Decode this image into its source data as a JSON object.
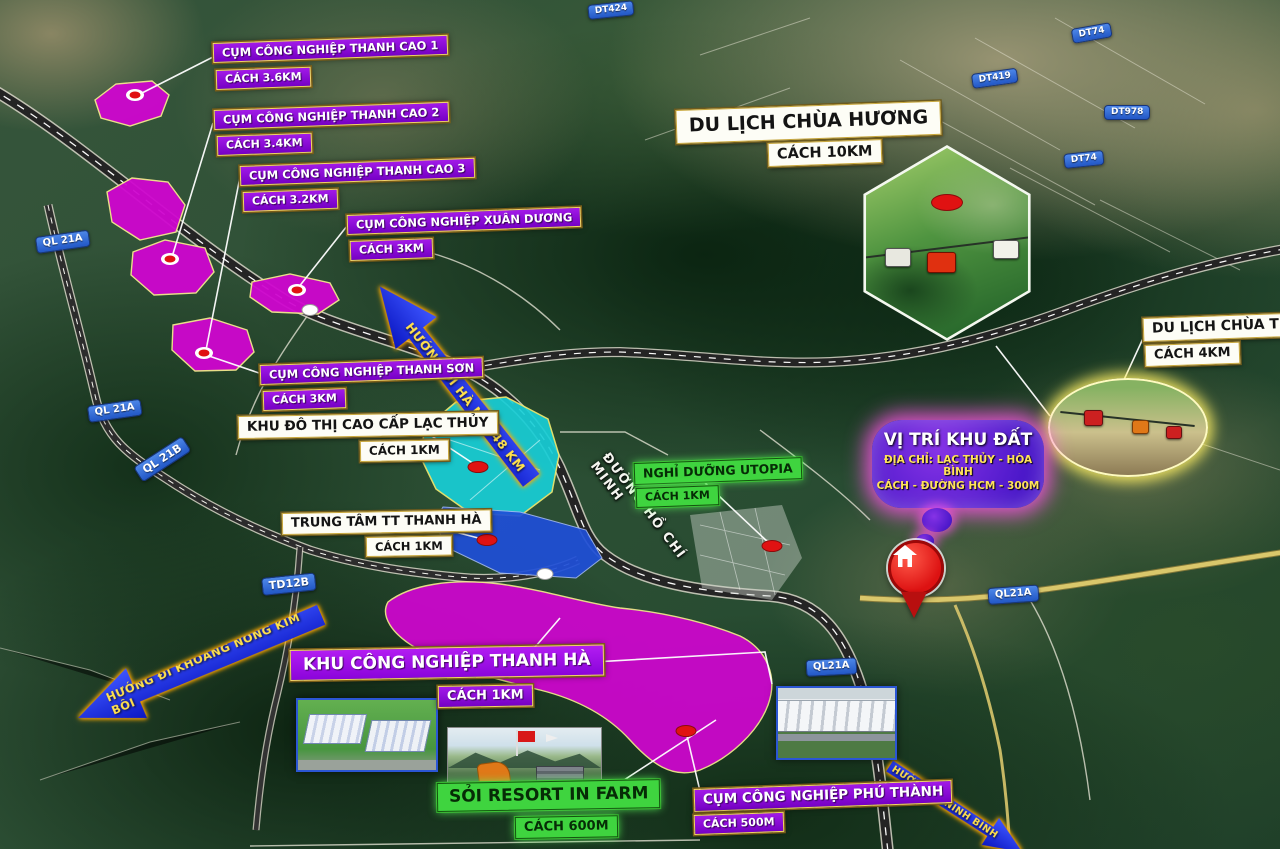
{
  "pois": {
    "thanh_cao_1": {
      "label": "CỤM CÔNG NGHIỆP THANH CAO 1",
      "distance": "CÁCH 3.6KM"
    },
    "thanh_cao_2": {
      "label": "CỤM CÔNG NGHIỆP THANH CAO 2",
      "distance": "CÁCH 3.4KM"
    },
    "thanh_cao_3": {
      "label": "CỤM CÔNG NGHIỆP THANH CAO 3",
      "distance": "CÁCH 3.2KM"
    },
    "xuan_duong": {
      "label": "CỤM CÔNG NGHIỆP XUÂN DƯƠNG",
      "distance": "CÁCH 3KM"
    },
    "thanh_son": {
      "label": "CỤM CÔNG NGHIỆP THANH SƠN",
      "distance": "CÁCH 3KM"
    },
    "lac_thuy": {
      "label": "KHU ĐÔ THỊ CAO CẤP LẠC THỦY",
      "distance": "CÁCH 1KM"
    },
    "trung_tam": {
      "label": "TRUNG TÂM TT THANH HÀ",
      "distance": "CÁCH 1KM"
    },
    "utopia": {
      "label": "NGHỈ DƯỠNG UTOPIA",
      "distance": "CÁCH 1KM"
    },
    "chua_huong": {
      "label": "DU LỊCH CHÙA HƯƠNG",
      "distance": "CÁCH 10KM"
    },
    "chua_tien": {
      "label": "DU LỊCH CHÙA TIÊN",
      "distance": "CÁCH 4KM"
    },
    "kcn_thanh_ha": {
      "label": "KHU CÔNG NGHIỆP THANH HÀ",
      "distance": "CÁCH 1KM"
    },
    "soi_resort": {
      "label": "SỎI RESORT IN FARM",
      "distance": "CÁCH 600M"
    },
    "phu_thanh": {
      "label": "CỤM CÔNG NGHIỆP PHÚ THÀNH",
      "distance": "CÁCH 500M"
    }
  },
  "site_callout": {
    "title": "VỊ TRÍ KHU ĐẤT",
    "address": "ĐỊA CHỈ: LẠC THỦY - HÒA BÌNH",
    "distance": "CÁCH - ĐƯỜNG HCM - 300M"
  },
  "roads": {
    "hcm_road_name": "ĐƯỜNG HỒ CHÍ MINH",
    "badges": {
      "ql21a_top": "QL 21A",
      "ql21a_mid": "QL 21A",
      "ql21b": "QL 21B",
      "td12b": "TD12B",
      "ql21a_pin": "QL21A",
      "ql21a_south": "QL21A",
      "dt424": "DT424",
      "dt74_north": "DT74",
      "dt419": "DT419",
      "dt978": "DT978",
      "dt74_south": "DT74"
    }
  },
  "arrows": {
    "hanoi": "HƯỚNG ĐI HÀ NỘI 48 KM",
    "kim_boi": "HƯỚNG ĐI KHOÁNG NÓNG KIM BÔI",
    "ninh_binh": "HƯỚNG ĐI NINH BÌNH"
  },
  "colors": {
    "industrial_zone": "#cc08cc",
    "urban_zone": "#17ced6",
    "town_center_zone": "#1f4fd8",
    "badge_purple": "#8a04d8",
    "badge_green": "#3fd43f",
    "road_badge_blue": "#2e6bd8",
    "arrow_blue": "#1b32f0",
    "site_pin_red": "#e01818"
  }
}
